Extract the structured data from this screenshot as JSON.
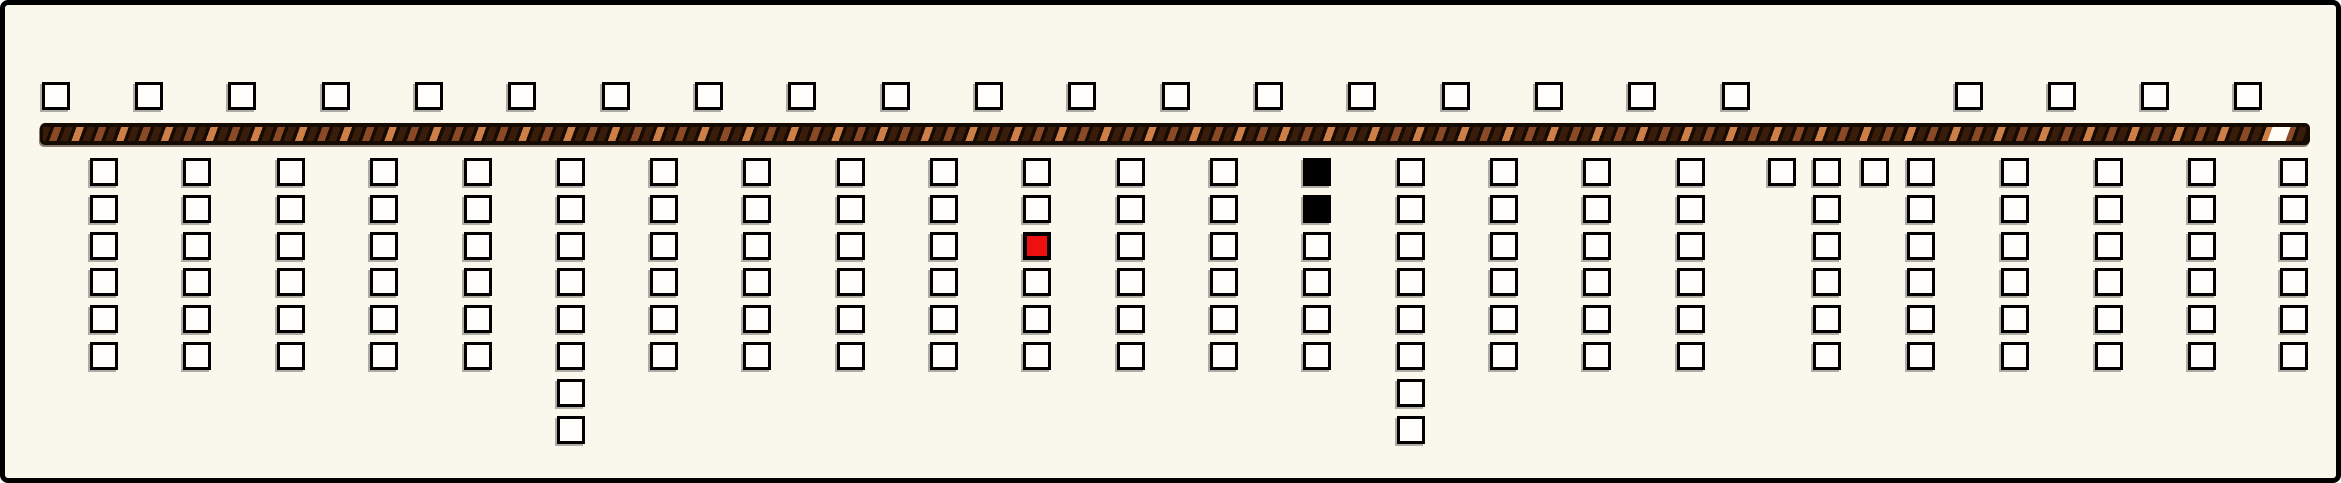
{
  "frame": {
    "width": 2341,
    "height": 483,
    "background": "#faf8ec",
    "border_color": "#000000"
  },
  "colors": {
    "frame_bg": "#faf8ec",
    "frame_border": "#000000",
    "square_fill": "#fffefb",
    "square_border": "#000000",
    "red_fill": "#ee1010",
    "black_fill": "#000000",
    "bar_base": "#160b03",
    "stripe_dark": "#3a1c0a",
    "stripe_mid": "#8a4a26",
    "stripe_light": "#cd7f47",
    "notch_fill": "#fffdf4"
  },
  "top_row": {
    "y": 77,
    "square_size": 28,
    "x_positions": [
      37,
      130,
      223,
      317,
      410,
      503,
      597,
      690,
      783,
      877,
      970,
      1063,
      1157,
      1250,
      1343,
      1437,
      1530,
      1623,
      1717,
      1950,
      2043,
      2136,
      2229
    ]
  },
  "bar": {
    "x": 35,
    "y": 118,
    "width": 2270,
    "height": 22,
    "notch_offset_from_right": 22
  },
  "grid": {
    "row_start_y": 153,
    "row_pitch": 36.8,
    "square_size": 28,
    "columns": [
      {
        "x": 85,
        "cells": [
          "empty",
          "empty",
          "empty",
          "empty",
          "empty",
          "empty"
        ]
      },
      {
        "x": 178,
        "cells": [
          "empty",
          "empty",
          "empty",
          "empty",
          "empty",
          "empty"
        ]
      },
      {
        "x": 272,
        "cells": [
          "empty",
          "empty",
          "empty",
          "empty",
          "empty",
          "empty"
        ]
      },
      {
        "x": 365,
        "cells": [
          "empty",
          "empty",
          "empty",
          "empty",
          "empty",
          "empty"
        ]
      },
      {
        "x": 459,
        "cells": [
          "empty",
          "empty",
          "empty",
          "empty",
          "empty",
          "empty"
        ]
      },
      {
        "x": 552,
        "cells": [
          "empty",
          "empty",
          "empty",
          "empty",
          "empty",
          "empty",
          "empty",
          "empty"
        ]
      },
      {
        "x": 645,
        "cells": [
          "empty",
          "empty",
          "empty",
          "empty",
          "empty",
          "empty"
        ]
      },
      {
        "x": 738,
        "cells": [
          "empty",
          "empty",
          "empty",
          "empty",
          "empty",
          "empty"
        ]
      },
      {
        "x": 832,
        "cells": [
          "empty",
          "empty",
          "empty",
          "empty",
          "empty",
          "empty"
        ]
      },
      {
        "x": 925,
        "cells": [
          "empty",
          "empty",
          "empty",
          "empty",
          "empty",
          "empty"
        ]
      },
      {
        "x": 1018,
        "cells": [
          "empty",
          "empty",
          "red",
          "empty",
          "empty",
          "empty"
        ]
      },
      {
        "x": 1112,
        "cells": [
          "empty",
          "empty",
          "empty",
          "empty",
          "empty",
          "empty"
        ]
      },
      {
        "x": 1205,
        "cells": [
          "empty",
          "empty",
          "empty",
          "empty",
          "empty",
          "empty"
        ]
      },
      {
        "x": 1298,
        "cells": [
          "black",
          "black",
          "empty",
          "empty",
          "empty",
          "empty"
        ]
      },
      {
        "x": 1392,
        "cells": [
          "empty",
          "empty",
          "empty",
          "empty",
          "empty",
          "empty",
          "empty",
          "empty"
        ]
      },
      {
        "x": 1485,
        "cells": [
          "empty",
          "empty",
          "empty",
          "empty",
          "empty",
          "empty"
        ]
      },
      {
        "x": 1578,
        "cells": [
          "empty",
          "empty",
          "empty",
          "empty",
          "empty",
          "empty"
        ]
      },
      {
        "x": 1672,
        "cells": [
          "empty",
          "empty",
          "empty",
          "empty",
          "empty",
          "empty"
        ]
      },
      {
        "x": 1763,
        "cells": [
          "empty"
        ]
      },
      {
        "x": 1808,
        "cells": [
          "empty",
          "empty",
          "empty",
          "empty",
          "empty",
          "empty"
        ]
      },
      {
        "x": 1856,
        "cells": [
          "empty"
        ]
      },
      {
        "x": 1902,
        "cells": [
          "empty",
          "empty",
          "empty",
          "empty",
          "empty",
          "empty"
        ]
      },
      {
        "x": 1996,
        "cells": [
          "empty",
          "empty",
          "empty",
          "empty",
          "empty",
          "empty"
        ]
      },
      {
        "x": 2090,
        "cells": [
          "empty",
          "empty",
          "empty",
          "empty",
          "empty",
          "empty"
        ]
      },
      {
        "x": 2183,
        "cells": [
          "empty",
          "empty",
          "empty",
          "empty",
          "empty",
          "empty"
        ]
      },
      {
        "x": 2275,
        "cells": [
          "empty",
          "empty",
          "empty",
          "empty",
          "empty",
          "empty"
        ]
      }
    ]
  }
}
